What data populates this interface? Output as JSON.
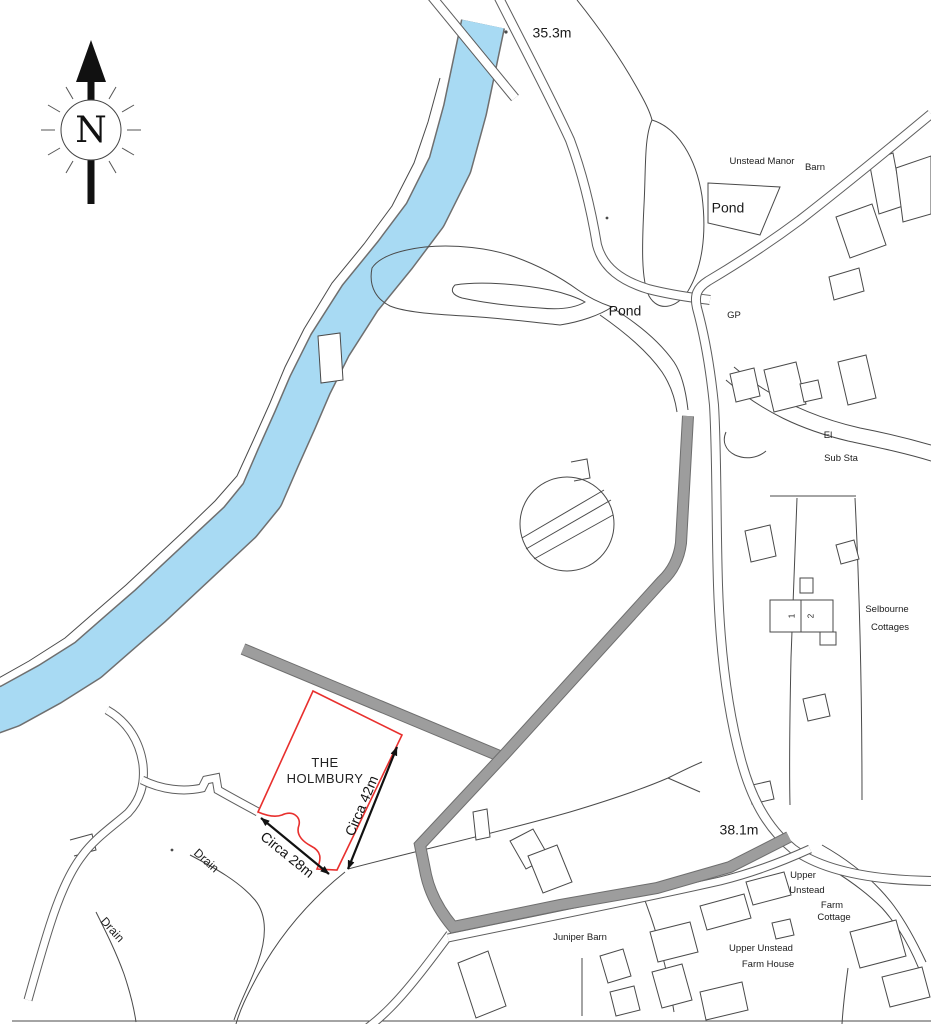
{
  "map": {
    "compass": {
      "letter": "N"
    },
    "spot_heights": {
      "north": "35.3m",
      "south": "38.1m"
    },
    "water_labels": {
      "pond_ne": "Pond",
      "pond_center": "Pond"
    },
    "place_labels": {
      "unstead_manor": "Unstead Manor",
      "barn": "Barn",
      "gp": "GP",
      "el": "El",
      "sub_sta": "Sub Sta",
      "selbourne_1": "Selbourne",
      "selbourne_2": "Cottages",
      "cottage_no_1": "1",
      "cottage_no_2": "2",
      "upper_1": "Upper",
      "upper_2": "Unstead",
      "farm_cottage_1": "Farm",
      "farm_cottage_2": "Cottage",
      "juniper_barn": "Juniper Barn",
      "farmhouse_1": "Upper Unstead",
      "farmhouse_2": "Farm House",
      "drain_east": "Drain",
      "drain_west": "Drain"
    },
    "site": {
      "name_1": "THE",
      "name_2": "HOLMBURY",
      "dim_long": "Circa 42m",
      "dim_short": "Circa 28m"
    },
    "colors": {
      "water": "#a8daf3",
      "track": "#9d9d9d",
      "site_outline": "#e8302e",
      "line": "#4a4a4a"
    }
  }
}
